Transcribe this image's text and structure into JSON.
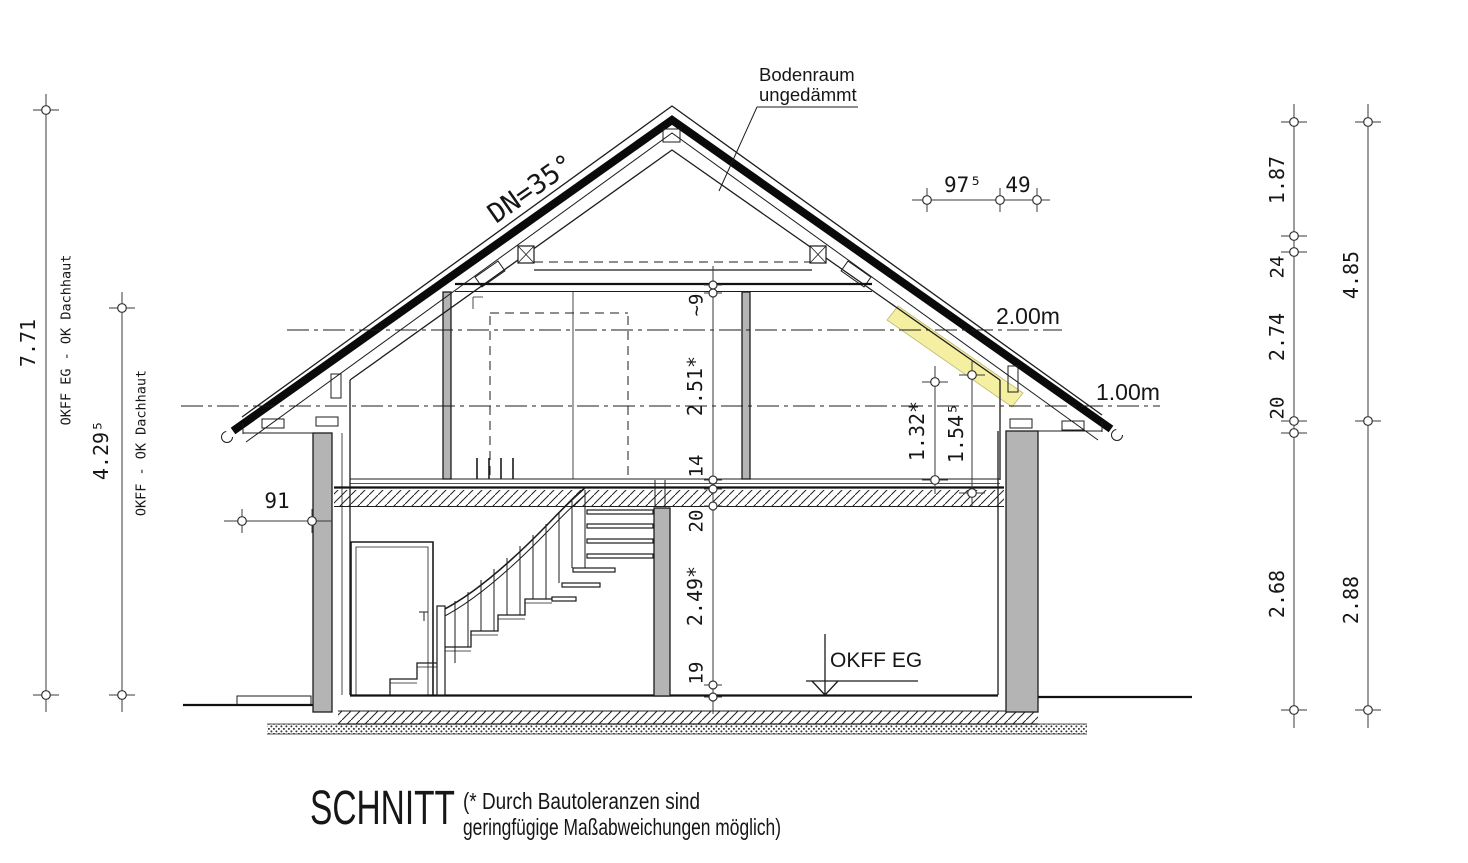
{
  "drawing": {
    "title": "SCHNITT",
    "note_line1": "(* Durch Bautoleranzen sind",
    "note_line2": "geringfügige Maßabweichungen möglich)",
    "labels": {
      "bodenraum_line1": "Bodenraum",
      "bodenraum_line2": "ungedämmt",
      "roof_pitch": "DN=35°",
      "level_2m": "2.00m",
      "level_1m": "1.00m",
      "okff_eg": "OKFF EG"
    },
    "dimensions": {
      "left_total_value": "7.71",
      "left_total_label": "OKFF EG - OK Dachhaut",
      "left_upper_value": "4.29⁵",
      "left_upper_label": "OKFF - OK Dachhaut",
      "eave_offset": "91",
      "top_right": [
        "97⁵",
        "49"
      ],
      "center_chain": [
        "~9",
        "2.51*",
        "14",
        "20",
        "2.49*",
        "19"
      ],
      "attic_heights": [
        "1.32*",
        "1.54⁵"
      ],
      "right_chain_inner": [
        "1.87",
        "24",
        "2.74",
        "20",
        "2.68"
      ],
      "right_chain_outer": [
        "4.85",
        "2.88"
      ]
    },
    "colors": {
      "wall_fill": "#b4b4b4",
      "roof_highlight": "#f5efa2",
      "line": "#1c1c1c"
    }
  }
}
